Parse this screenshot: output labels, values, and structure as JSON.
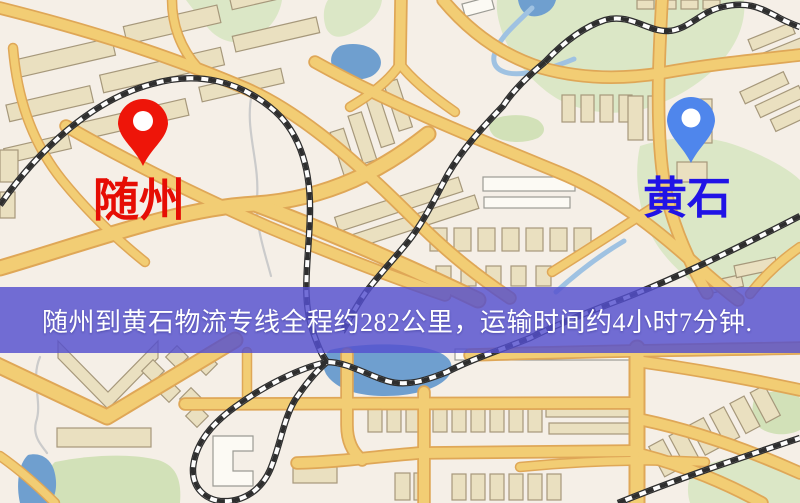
{
  "markers": {
    "origin": {
      "name": "随州",
      "pin_color": "#ee1509",
      "label_color": "#e60d04"
    },
    "destination": {
      "name": "黄石",
      "pin_color": "#4f86ec",
      "label_color": "#2013e6"
    }
  },
  "banner": {
    "text": "随州到黄石物流专线全程约282公里，运输时间约4小时7分钟.",
    "distance_km": "282",
    "duration": "4小时7分钟",
    "background": "#544fce",
    "text_color": "#ffffff"
  },
  "map_colors": {
    "background": "#f5efe7",
    "road_fill": "#f2cd74",
    "road_casing": "#dfa757",
    "building_fill": "#eae0c0",
    "building_white": "#fcfaf4",
    "park": "#dbe7c6",
    "water": "#6f9fcf",
    "water_light": "#9fc2e2",
    "railway": "#2e2e2e"
  }
}
